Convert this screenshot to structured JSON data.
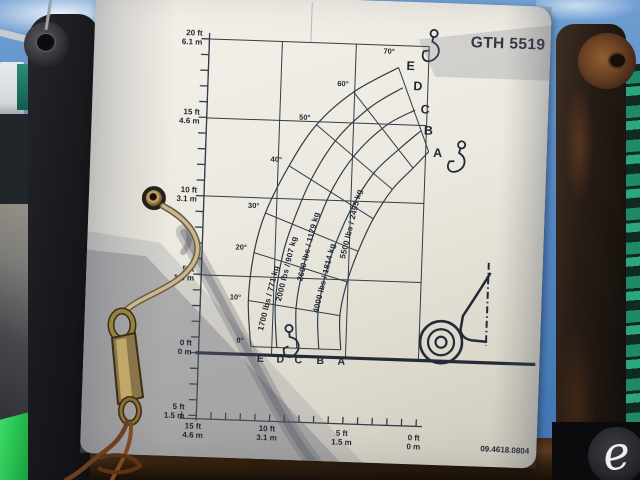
{
  "scene": {
    "watermark_letter": "e"
  },
  "placard": {
    "model": "GTH 5519",
    "part_number": "09.4618.0804",
    "chart": {
      "left_axis_labels": [
        {
          "ft": "20 ft",
          "m": "6.1 m"
        },
        {
          "ft": "15 ft",
          "m": "4.6 m"
        },
        {
          "ft": "10 ft",
          "m": "3.1 m"
        },
        {
          "ft": "5 ft",
          "m": "1.5 m"
        },
        {
          "ft": "0 ft",
          "m": "0 m"
        },
        {
          "ft": "5 ft",
          "m": "1.5 m"
        }
      ],
      "bottom_axis_labels": [
        {
          "ft": "15 ft",
          "m": "4.6 m"
        },
        {
          "ft": "10 ft",
          "m": "3.1 m"
        },
        {
          "ft": "5 ft",
          "m": "1.5 m"
        },
        {
          "ft": "0 ft",
          "m": "0 m"
        }
      ],
      "angle_labels": [
        "70°",
        "60°",
        "50°",
        "40°",
        "30°",
        "20°",
        "10°",
        "0°"
      ],
      "zone_letters": [
        "E",
        "D",
        "C",
        "B",
        "A"
      ],
      "capacity_labels": [
        "1700 lbs / 771 kg",
        "2000 lbs / 907 kg",
        "2600 lbs / 1179 kg",
        "4000 lbs / 1814 kg",
        "5500 lbs / 2495 kg"
      ]
    }
  },
  "chart_data": {
    "type": "line",
    "title": "GTH 5519 telehandler load capacity chart",
    "xlabel": "Distance from front of machine (ft / m)",
    "ylabel": "Lift height (ft / m)",
    "x_ticks": [
      "15 ft / 4.6 m",
      "10 ft / 3.1 m",
      "5 ft / 1.5 m",
      "0 ft / 0 m"
    ],
    "y_ticks": [
      "20 ft / 6.1 m",
      "15 ft / 4.6 m",
      "10 ft / 3.1 m",
      "5 ft / 1.5 m",
      "0 ft / 0 m",
      "-5 ft / -1.5 m"
    ],
    "boom_angle_lines_deg": [
      0,
      10,
      20,
      30,
      40,
      50,
      60,
      70
    ],
    "load_zones": [
      {
        "zone": "A",
        "capacity_lbs": 5500,
        "capacity_kg": 2495
      },
      {
        "zone": "B",
        "capacity_lbs": 4000,
        "capacity_kg": 1814
      },
      {
        "zone": "C",
        "capacity_lbs": 2600,
        "capacity_kg": 1179
      },
      {
        "zone": "D",
        "capacity_lbs": 2000,
        "capacity_kg": 907
      },
      {
        "zone": "E",
        "capacity_lbs": 1700,
        "capacity_kg": 771
      }
    ],
    "grid": true,
    "legend_position": "none"
  }
}
